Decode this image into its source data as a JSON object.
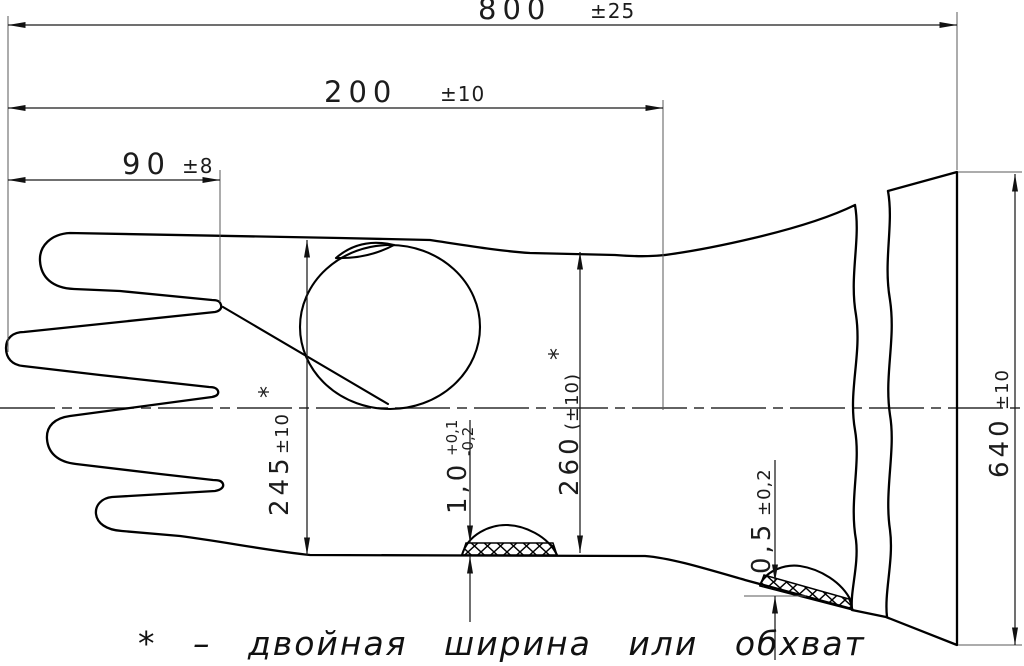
{
  "drawing": {
    "type": "technical-drawing-glove",
    "footnote": "* – двойная ширина или обхват",
    "dimensions": {
      "overall_length": {
        "value": "800",
        "tolerance": "±25"
      },
      "cuff_length": {
        "value": "200",
        "tolerance": "±10"
      },
      "finger_length": {
        "value": "90",
        "tolerance": "±8"
      },
      "palm_width": {
        "value": "245",
        "tolerance": "±10",
        "note_mark": "*"
      },
      "wrist_width": {
        "value": "260",
        "tolerance": "(±10)",
        "note_mark": "*"
      },
      "cuff_width": {
        "value": "640",
        "tolerance": "±10"
      },
      "palm_thickness": {
        "value": "1,0",
        "tolerance_plus": "+0,1",
        "tolerance_minus": "-0,2"
      },
      "cuff_thickness": {
        "value": "0,5",
        "tolerance": "±0,2"
      }
    },
    "colors": {
      "line": "#000000",
      "extension_line": "#5a5a5a",
      "background": "#ffffff"
    }
  }
}
